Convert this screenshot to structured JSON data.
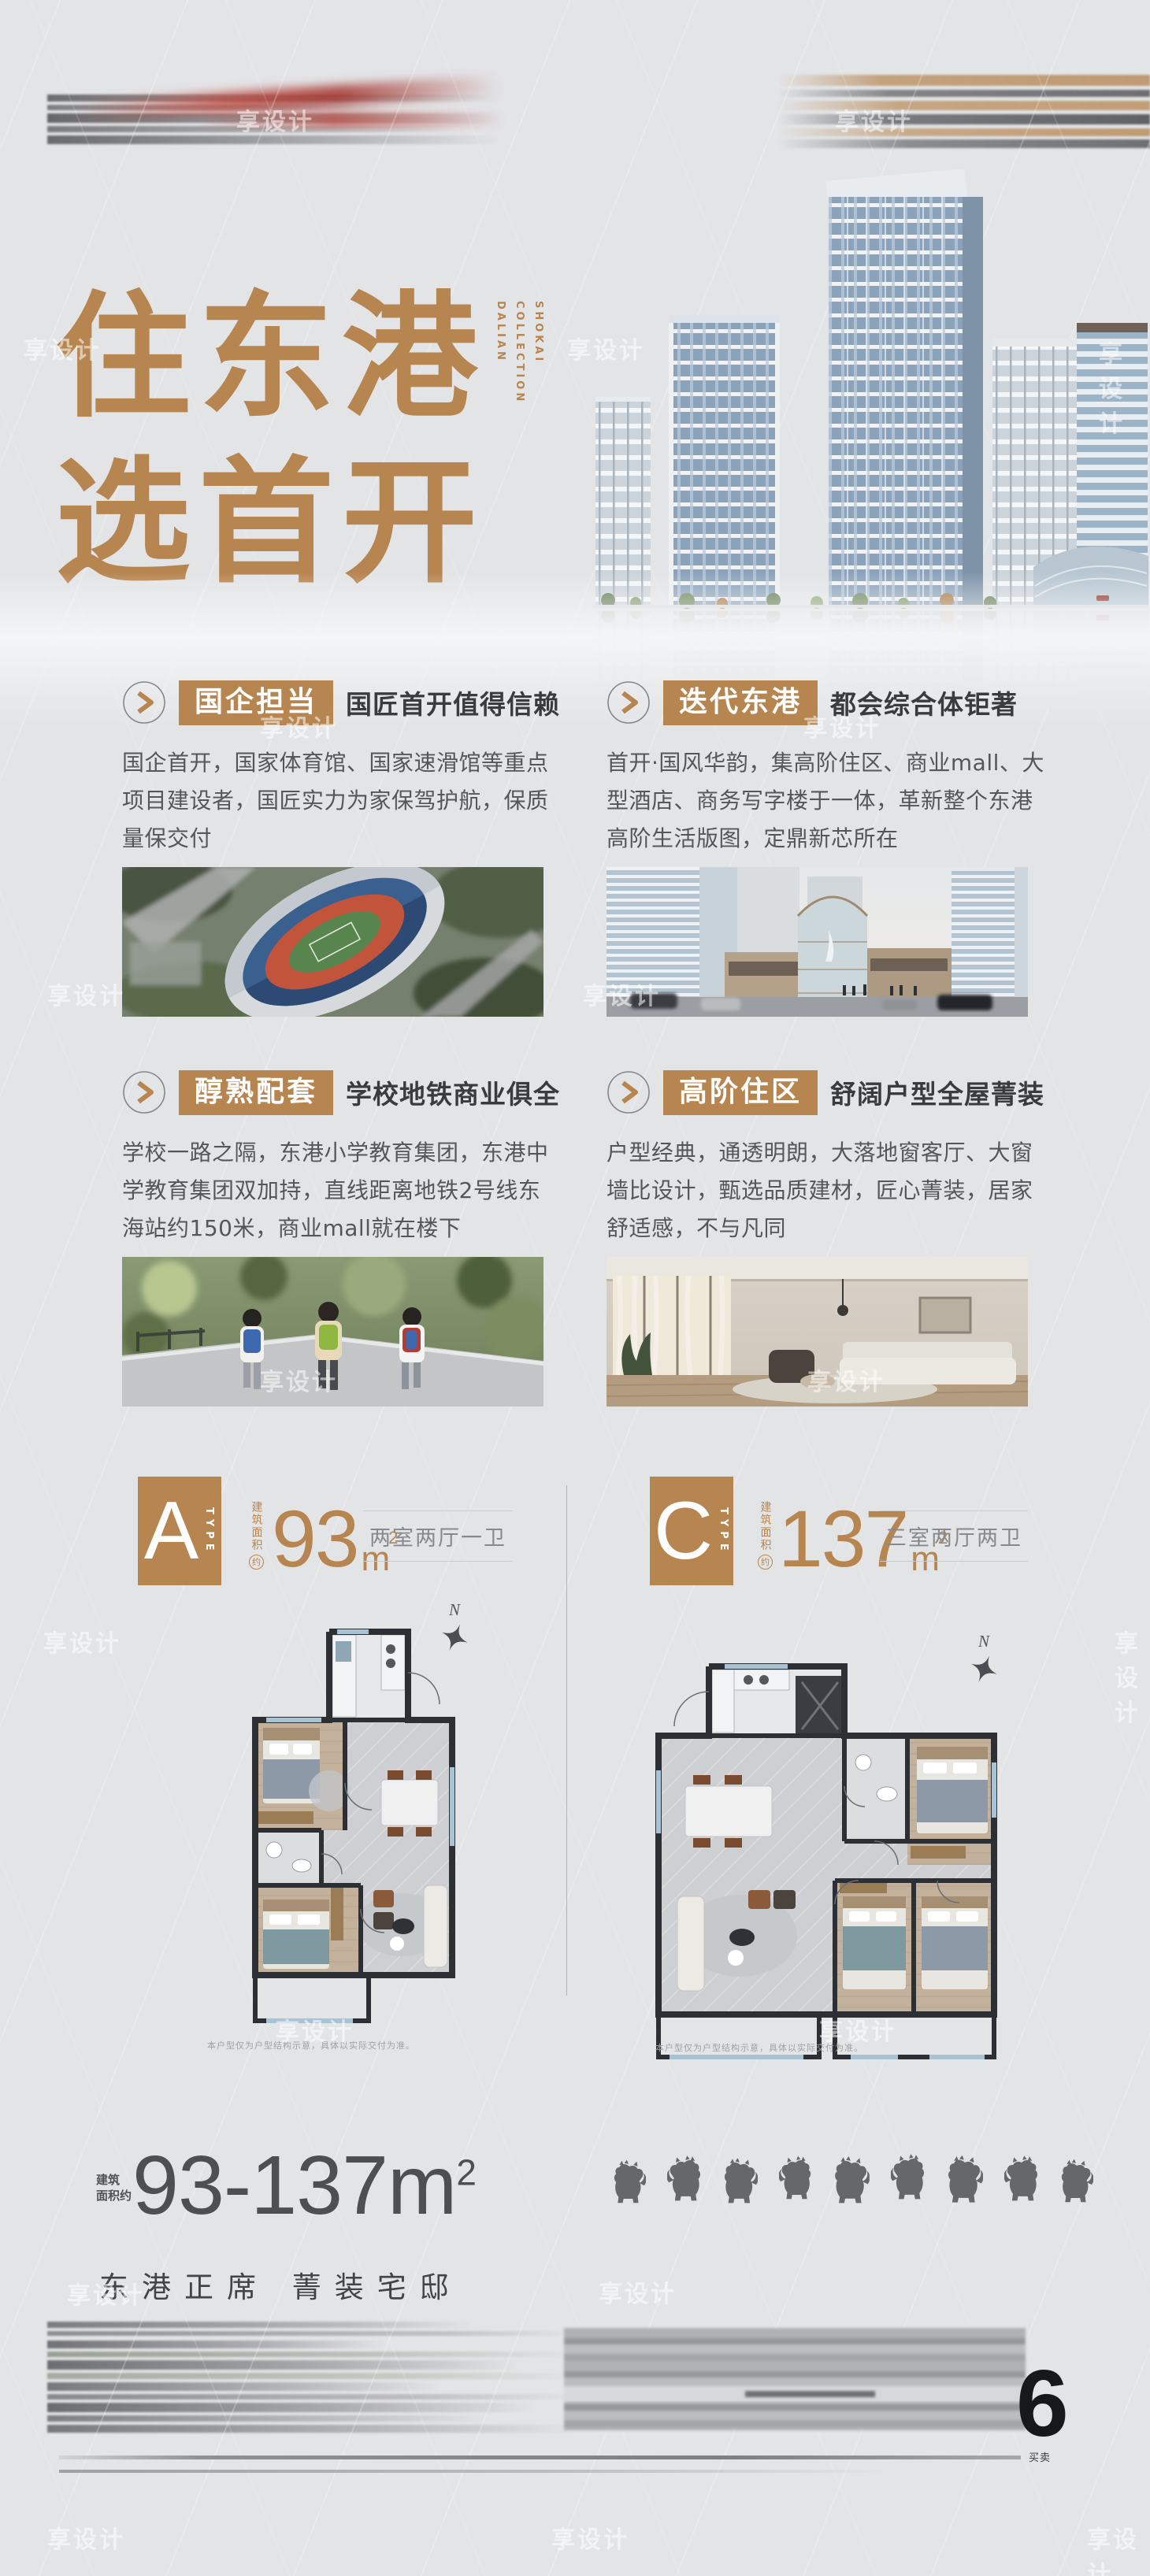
{
  "poster": {
    "bg": "#e3e4e6",
    "accent": "#b7854f",
    "watermark": "享设计",
    "icons": {
      "section_bullet": "chevron-right-circle-icon",
      "north_star": "north-star-icon",
      "ridge_beasts": "roof-ridge-beast-icons"
    },
    "header": {
      "title_line1": "住东港",
      "title_line2": "选首开",
      "brand_lines": [
        "SHOKAI",
        "COLLECTION",
        "DALIAN"
      ],
      "hero_image": "city-towers-render"
    },
    "sections": [
      {
        "tag": "国企担当",
        "subtitle": "国匠首开值得信赖",
        "body": "国企首开，国家体育馆、国家速滑馆等重点项目建设者，国匠实力为家保驾护航，保质量保交付",
        "image": "stadium-aerial-photo"
      },
      {
        "tag": "迭代东港",
        "subtitle": "都会综合体钜著",
        "body": "首开·国风华韵，集高阶住区、商业mall、大型酒店、商务写字楼于一体，革新整个东港高阶生活版图，定鼎新芯所在",
        "image": "mall-complex-render"
      },
      {
        "tag": "醇熟配套",
        "subtitle": "学校地铁商业俱全",
        "body": "学校一路之隔，东港小学教育集团，东港中学教育集团双加持，直线距离地铁2号线东海站约150米，商业mall就在楼下",
        "image": "children-walking-photo"
      },
      {
        "tag": "高阶住区",
        "subtitle": "舒阔户型全屋菁装",
        "body": "户型经典，通透明朗，大落地窗客厅、大窗墙比设计，甄选品质建材，匠心菁装，居家舒适感，不与凡同",
        "image": "living-room-photo"
      }
    ],
    "plans": [
      {
        "letter": "A",
        "type_word": "TYPE",
        "area_label": "建筑面积",
        "area_label_circle": "约",
        "area": "93",
        "unit": "m",
        "unit_sup": "2",
        "rooms": "两室两厅一卫",
        "north_label": "N",
        "disclaimer": "本户型仅为户型结构示意，具体以实际交付为准。"
      },
      {
        "letter": "C",
        "type_word": "TYPE",
        "area_label": "建筑面积",
        "area_label_circle": "约",
        "area": "137",
        "unit": "m",
        "unit_sup": "2",
        "rooms": "三室两厅两卫",
        "north_label": "N",
        "disclaimer": "本户型仅为户型结构示意，具体以实际交付为准。"
      }
    ],
    "footer": {
      "area_small_1": "建筑",
      "area_small_2": "面积约",
      "area_range": "93-137m",
      "area_range_sup": "2",
      "slogan": "东港正席  菁装宅邸",
      "page_number": "6",
      "side_label": "买卖"
    }
  }
}
